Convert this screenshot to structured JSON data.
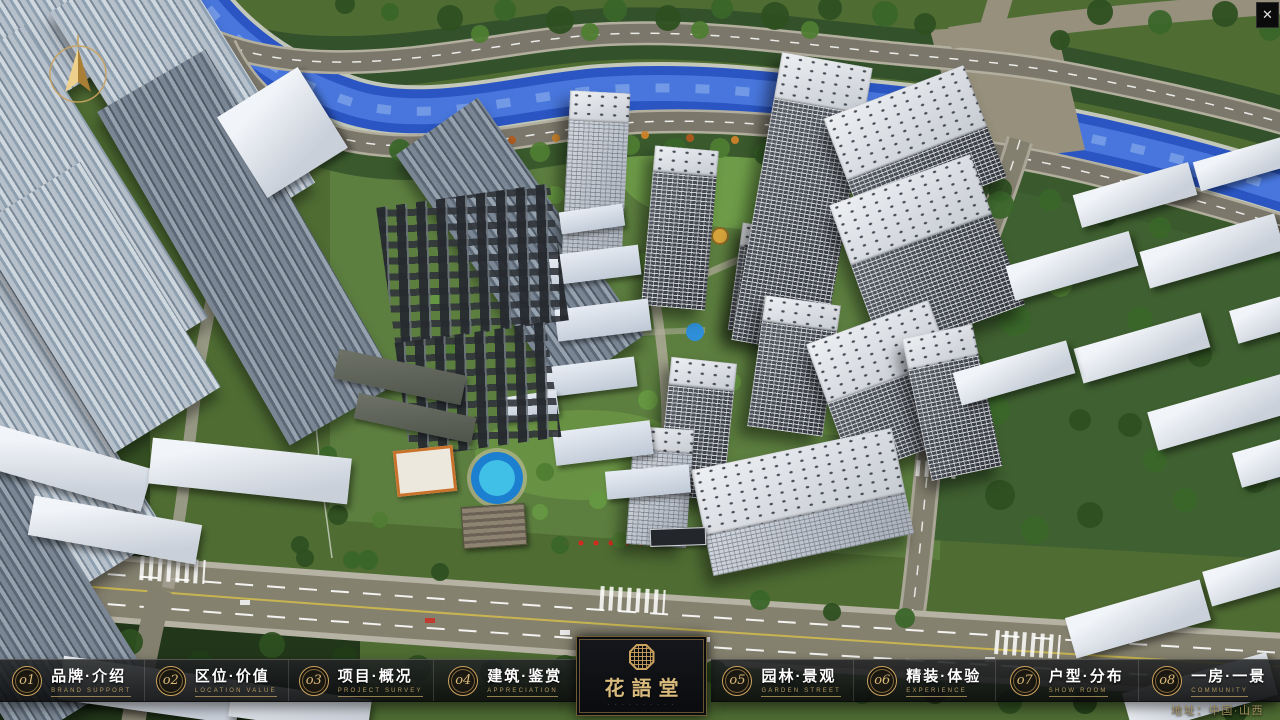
{
  "window": {
    "close_icon": "✕"
  },
  "nav": {
    "items": [
      {
        "num": "o1",
        "zh": "品牌·介绍",
        "en": "BRAND SUPPORT"
      },
      {
        "num": "o2",
        "zh": "区位·价值",
        "en": "LOCATION VALUE"
      },
      {
        "num": "o3",
        "zh": "项目·概况",
        "en": "PROJECT SURVEY"
      },
      {
        "num": "o4",
        "zh": "建筑·鉴赏",
        "en": "APPRECIATION"
      },
      {
        "num": "o5",
        "zh": "园林·景观",
        "en": "GARDEN STREET"
      },
      {
        "num": "o6",
        "zh": "精装·体验",
        "en": "EXPERIENCE"
      },
      {
        "num": "o7",
        "zh": "户型·分布",
        "en": "SHOW ROOM"
      },
      {
        "num": "o8",
        "zh": "一房·一景",
        "en": "COMMUNITY"
      }
    ]
  },
  "logo": {
    "title": "花語堂",
    "subtext": "· · · · · · · · · ·"
  },
  "footer": {
    "address": "地址：中国·山西"
  },
  "colors": {
    "gold": "#c9a25f",
    "bar_bg": "#0d0f11",
    "river": "#2a55c2",
    "grass": "#4f6c33",
    "road": "#85816f"
  }
}
